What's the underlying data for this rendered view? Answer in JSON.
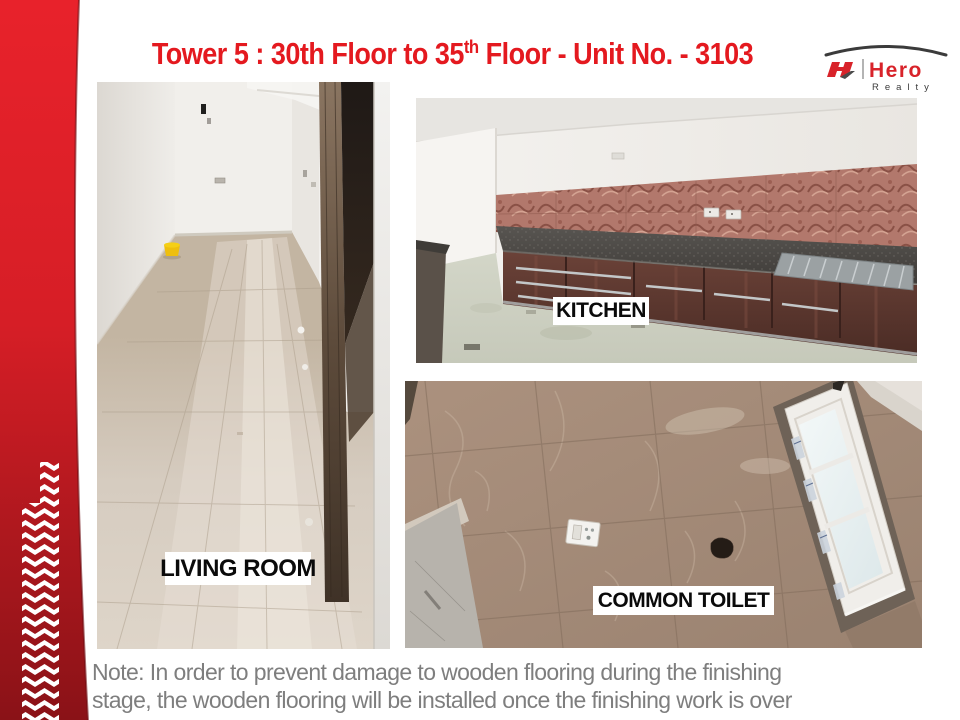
{
  "slide": {
    "title": {
      "part1": "Tower 5 : 30th Floor to 35",
      "sup": "th",
      "part2": " Floor - Unit No. - 3103",
      "color": "#E4191F"
    },
    "logo": {
      "brand": "Hero",
      "sub": "Realty",
      "brand_color": "#D8232A",
      "sub_color": "#3B3B3B"
    },
    "photos": [
      {
        "id": "living-room",
        "label": "LIVING ROOM"
      },
      {
        "id": "kitchen",
        "label": "KITCHEN"
      },
      {
        "id": "common-toilet",
        "label": "COMMON TOILET"
      }
    ],
    "note": {
      "line1": "Note: In order to prevent damage to wooden flooring during the finishing",
      "line2": "stage, the wooden flooring will be installed once the finishing work is over",
      "color": "#7E7E7E"
    },
    "colors": {
      "sidebar_top": "#E8222B",
      "sidebar_mid": "#D61E26",
      "sidebar_bottom": "#8A1217",
      "label_bg": "#FFFFFF",
      "label_text": "#0A0A0A"
    }
  }
}
